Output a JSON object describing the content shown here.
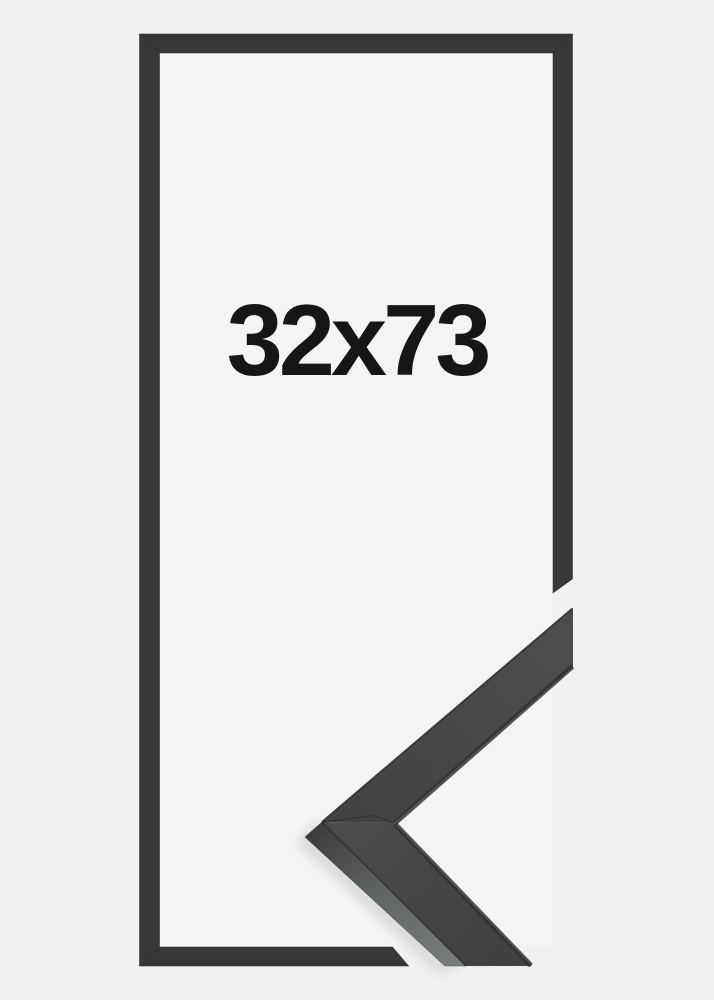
{
  "frame": {
    "size_label": "32x73"
  },
  "colors": {
    "background": "#f1f1f2",
    "inner_area": "#f4f4f4",
    "frame_bar": "#383838",
    "frame_bar_edge": "#2c2c2c",
    "corner_top_face": "#424242",
    "corner_side_face": "#6e7272",
    "corner_edge": "#2a2a2a",
    "shadow": "#d9d9d9",
    "label_text": "#161616"
  }
}
